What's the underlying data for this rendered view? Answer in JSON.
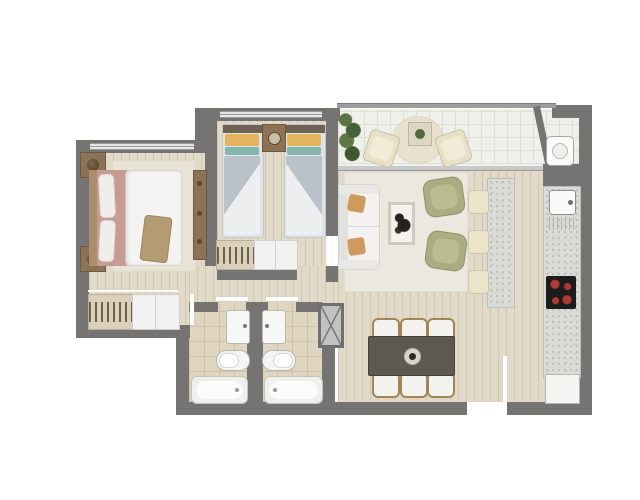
{
  "document": {
    "type": "apartment floor plan",
    "style": "top-down 2D rendered floor plan with furniture, no text labels",
    "visible_text": []
  },
  "palette": {
    "wall": "#767473",
    "railing": "#9c9c9c",
    "wood_floor": "#e2dac8",
    "wood_plank_line": "#d2c8b1",
    "balcony_tile": "#eef0e9",
    "balcony_tile_line": "#dde0d6",
    "bathroom_tile": "#e0d6c0",
    "bathroom_tile_line": "#cfc4a9",
    "rug": "#ebe8df",
    "bedroom_rug": "#e9e3d5",
    "granite_counter": "#dadad6",
    "white_furniture": "#f3f2f0",
    "sofa_pillow_orange": "#cf9a5e",
    "armchair_green": "#a9ae82",
    "bed_pink": "#c79a92",
    "bed_throw_tan": "#b39b72",
    "twin_bed_gray": "#b9c2c9",
    "twin_pillow_yellow": "#e4b55e",
    "twin_pillow_teal": "#86b7ae",
    "wood_furniture": "#8d7355",
    "dining_table": "#5e5950",
    "cooktop": "#1c1c1c",
    "burner_red": "#b23a33",
    "plant_green": "#53683c",
    "window_glass": "#e6e6e6",
    "door_leaf": "#ffffff"
  },
  "rooms": [
    {
      "name": "master-bedroom",
      "furniture": [
        "double-bed",
        "white-duvet",
        "pink-sheets",
        "throw-blanket",
        "nightstand-top",
        "nightstand-bottom",
        "table-lamps",
        "area-rug",
        "tall-dresser",
        "built-in-closet-with-hangers"
      ]
    },
    {
      "name": "second-bedroom",
      "furniture": [
        "twin-bed-left",
        "twin-bed-right",
        "shared-nightstand",
        "wardrobe-with-hangers-and-doors"
      ]
    },
    {
      "name": "hallway",
      "furniture": []
    },
    {
      "name": "bathroom-left",
      "furniture": [
        "washbasin",
        "toilet",
        "bathtub"
      ]
    },
    {
      "name": "bathroom-right",
      "furniture": [
        "washbasin",
        "toilet",
        "bathtub"
      ]
    },
    {
      "name": "living-room",
      "furniture": [
        "white-sofa",
        "two-orange-pillows",
        "glass-coffee-table",
        "green-armchair-top",
        "green-armchair-bottom",
        "area-rug"
      ]
    },
    {
      "name": "dining-area",
      "furniture": [
        "dark-dining-table",
        "six-chairs",
        "centerpiece"
      ]
    },
    {
      "name": "kitchen",
      "furniture": [
        "island-counter",
        "three-bar-stools",
        "counter-run",
        "sink",
        "four-burner-cooktop",
        "refrigerator"
      ]
    },
    {
      "name": "balcony",
      "furniture": [
        "planter",
        "two-outdoor-chairs",
        "round-rug",
        "side-table-with-plant",
        "laundry-unit"
      ]
    },
    {
      "name": "entry",
      "furniture": [
        "entry-door-leaf"
      ]
    }
  ],
  "counts": {
    "bedrooms": 2,
    "bathrooms": 2,
    "twin_beds": 2,
    "dining_chairs": 6,
    "bar_stools": 3,
    "balcony_chairs": 2,
    "cooktop_burners": 4,
    "toilets": 2,
    "bathtubs": 2,
    "washbasins": 2
  }
}
